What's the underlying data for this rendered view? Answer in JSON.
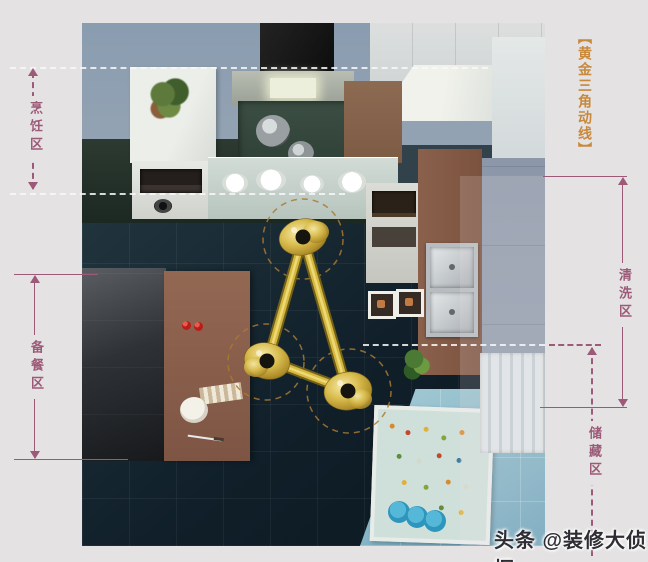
{
  "colors": {
    "background": "#e4e2e3",
    "annotation_purple": "#9c5a78",
    "title_orange": "#c8893c",
    "gold_triangle": "#c9a83c",
    "white_dash": "#f8f8f8",
    "floor_dark": "#101f29",
    "floor_blue": "#6ba4ba"
  },
  "title": {
    "text": "【黄金三角动线】"
  },
  "zones": {
    "cooking": {
      "label": "烹饪区",
      "line_style": "dashed",
      "side": "left"
    },
    "prep": {
      "label": "备餐区",
      "line_style": "solid",
      "side": "left"
    },
    "washing": {
      "label": "清洗区",
      "line_style": "solid",
      "side": "right"
    },
    "storage": {
      "label": "储藏区",
      "line_style": "dashed",
      "side": "right"
    }
  },
  "watermark": {
    "text": "头条 @装修大侦探"
  }
}
